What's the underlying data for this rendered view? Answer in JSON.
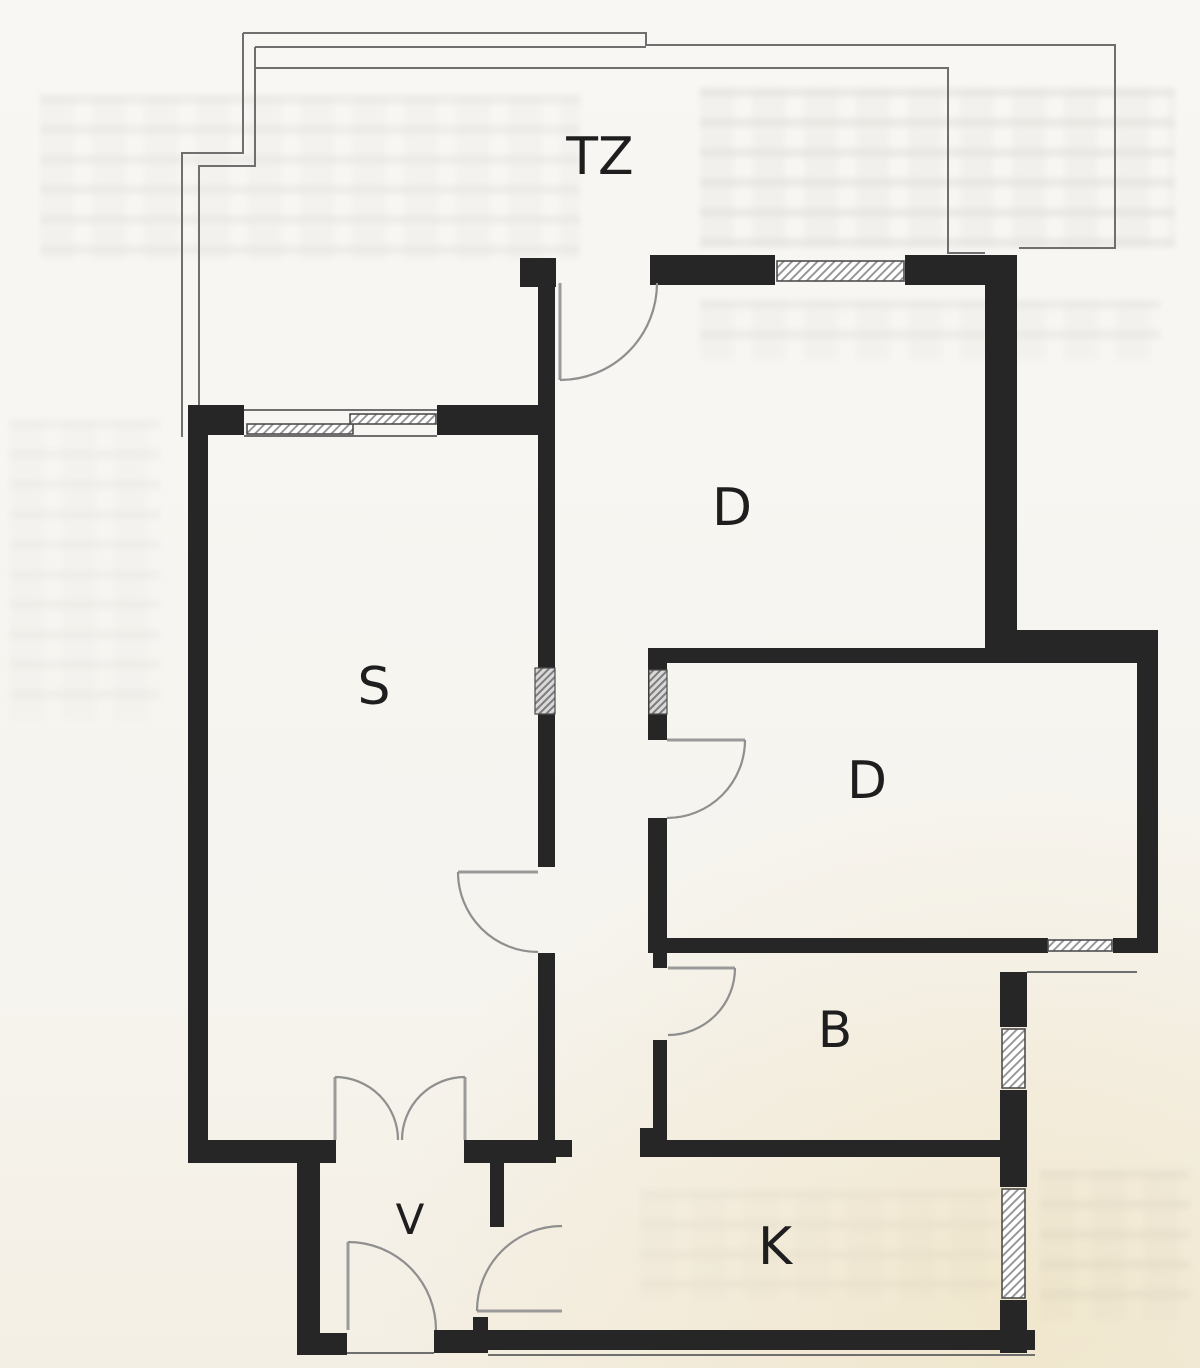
{
  "plan": {
    "title_hint": "apartment floor plan scan",
    "rooms": [
      {
        "key": "terrace",
        "label": "TZ"
      },
      {
        "key": "room-d1",
        "label": "D"
      },
      {
        "key": "living-s",
        "label": "S"
      },
      {
        "key": "room-d2",
        "label": "D"
      },
      {
        "key": "bath-b",
        "label": "B"
      },
      {
        "key": "vestibule-v",
        "label": "V"
      },
      {
        "key": "kitchen-k",
        "label": "K"
      }
    ],
    "colors": {
      "paper": "#f7f5f1",
      "wall": "#262626",
      "thin_line": "#6f6f6f",
      "door_arc": "#8f8f8f",
      "window_hatch": "#8f8f8f",
      "label": "#1e1e1e",
      "corner_tint": "#e8d296"
    }
  }
}
